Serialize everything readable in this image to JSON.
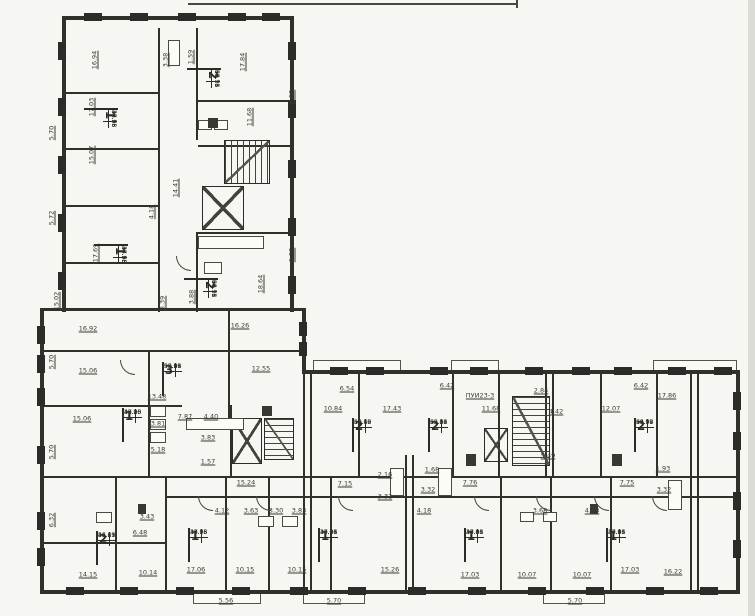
{
  "colors": {
    "paper": "#f6f6f2",
    "ink": "#31302b",
    "label_ink": "#3b3a33"
  },
  "apartment_tables": [
    {
      "rooms": "2",
      "x": 203,
      "y": 52,
      "rot": 1,
      "values": [
        "34.78",
        "59.71",
        "62.96",
        "66.15"
      ]
    },
    {
      "rooms": "1",
      "x": 100,
      "y": 92,
      "rot": 1,
      "values": [
        "17.06",
        "34.98",
        "37.75",
        "40.55"
      ]
    },
    {
      "rooms": "1",
      "x": 110,
      "y": 228,
      "rot": 1,
      "values": [
        "17.06",
        "34.98",
        "37.75",
        "40.55"
      ]
    },
    {
      "rooms": "2",
      "x": 200,
      "y": 262,
      "rot": 1,
      "values": [
        "34.78",
        "59.71",
        "62.96",
        "66.15"
      ]
    },
    {
      "rooms": "3",
      "x": 162,
      "y": 362,
      "rot": 0,
      "values": [
        "50.26",
        "93.98",
        "96.81",
        "99.66"
      ]
    },
    {
      "rooms": "1",
      "x": 122,
      "y": 408,
      "rot": 0,
      "values": [
        "15.06",
        "37.20",
        "40.05",
        "42.90"
      ]
    },
    {
      "rooms": "2",
      "x": 96,
      "y": 531,
      "rot": 0,
      "values": [
        "26.29",
        "45.15",
        "48.41",
        "51.67"
      ]
    },
    {
      "rooms": "1",
      "x": 188,
      "y": 528,
      "rot": 0,
      "values": [
        "17.06",
        "34.98",
        "37.75",
        "40.55"
      ]
    },
    {
      "rooms": "1",
      "x": 318,
      "y": 528,
      "rot": 0,
      "values": [
        "17.06",
        "34.98",
        "37.81",
        "40.66"
      ]
    },
    {
      "rooms": "2",
      "x": 352,
      "y": 418,
      "rot": 0,
      "values": [
        "32.69",
        "58.16",
        "59.43",
        "62.70"
      ]
    },
    {
      "rooms": "2",
      "x": 428,
      "y": 418,
      "rot": 0,
      "values": [
        "35.56",
        "60.00",
        "63.21",
        "66.42"
      ]
    },
    {
      "rooms": "2",
      "x": 634,
      "y": 418,
      "rot": 0,
      "values": [
        "34.08",
        "63.57",
        "66.78",
        "69.99"
      ]
    },
    {
      "rooms": "1",
      "x": 464,
      "y": 528,
      "rot": 0,
      "values": [
        "17.03",
        "34.96",
        "37.81",
        "40.66"
      ]
    },
    {
      "rooms": "1",
      "x": 606,
      "y": 528,
      "rot": 0,
      "values": [
        "17.03",
        "34.96",
        "37.81",
        "40.66"
      ]
    }
  ],
  "dimension_labels": [
    {
      "t": "16.94",
      "x": 95,
      "y": 60,
      "r": 1
    },
    {
      "t": "17.84",
      "x": 243,
      "y": 62,
      "r": 1
    },
    {
      "t": "3.38",
      "x": 166,
      "y": 60,
      "r": 1
    },
    {
      "t": "1.59",
      "x": 191,
      "y": 57,
      "r": 1
    },
    {
      "t": "17.03",
      "x": 92,
      "y": 107,
      "r": 1
    },
    {
      "t": "5.70",
      "x": 52,
      "y": 133,
      "r": 1
    },
    {
      "t": "15.07",
      "x": 92,
      "y": 155,
      "r": 1
    },
    {
      "t": "6.52",
      "x": 292,
      "y": 97,
      "r": 1
    },
    {
      "t": "11.68",
      "x": 250,
      "y": 117,
      "r": 1
    },
    {
      "t": "14.41",
      "x": 176,
      "y": 188,
      "r": 1
    },
    {
      "t": "4.18",
      "x": 152,
      "y": 212,
      "r": 1
    },
    {
      "t": "5.72",
      "x": 52,
      "y": 218,
      "r": 1
    },
    {
      "t": "17.69",
      "x": 96,
      "y": 253,
      "r": 1
    },
    {
      "t": "6.52",
      "x": 292,
      "y": 255,
      "r": 1
    },
    {
      "t": "18.64",
      "x": 261,
      "y": 284,
      "r": 1
    },
    {
      "t": "3.88",
      "x": 192,
      "y": 297,
      "r": 1
    },
    {
      "t": "8.39",
      "x": 163,
      "y": 303,
      "r": 1
    },
    {
      "t": "15.02",
      "x": 57,
      "y": 301,
      "r": 1
    },
    {
      "t": "16.92",
      "x": 88,
      "y": 329,
      "r": 0
    },
    {
      "t": "16.26",
      "x": 240,
      "y": 326,
      "r": 0
    },
    {
      "t": "5.70",
      "x": 52,
      "y": 362,
      "r": 1
    },
    {
      "t": "15.06",
      "x": 88,
      "y": 371,
      "r": 0
    },
    {
      "t": "12.55",
      "x": 261,
      "y": 369,
      "r": 0
    },
    {
      "t": "13.48",
      "x": 157,
      "y": 397,
      "r": 0
    },
    {
      "t": "15.06",
      "x": 82,
      "y": 419,
      "r": 0
    },
    {
      "t": "5.70",
      "x": 52,
      "y": 452,
      "r": 1
    },
    {
      "t": "7.87",
      "x": 185,
      "y": 417,
      "r": 0
    },
    {
      "t": "4.40",
      "x": 211,
      "y": 417,
      "r": 0
    },
    {
      "t": "3.81",
      "x": 158,
      "y": 424,
      "r": 0
    },
    {
      "t": "5.18",
      "x": 158,
      "y": 450,
      "r": 0
    },
    {
      "t": "3.83",
      "x": 208,
      "y": 438,
      "r": 0
    },
    {
      "t": "1.57",
      "x": 208,
      "y": 462,
      "r": 0
    },
    {
      "t": "6.32",
      "x": 52,
      "y": 520,
      "r": 1
    },
    {
      "t": "3.43",
      "x": 147,
      "y": 517,
      "r": 0
    },
    {
      "t": "6.48",
      "x": 140,
      "y": 533,
      "r": 0
    },
    {
      "t": "14.15",
      "x": 88,
      "y": 575,
      "r": 0
    },
    {
      "t": "10.14",
      "x": 148,
      "y": 573,
      "r": 0
    },
    {
      "t": "17.06",
      "x": 196,
      "y": 570,
      "r": 0
    },
    {
      "t": "10.15",
      "x": 245,
      "y": 570,
      "r": 0
    },
    {
      "t": "5.56",
      "x": 226,
      "y": 601,
      "r": 0
    },
    {
      "t": "4.12",
      "x": 222,
      "y": 511,
      "r": 0
    },
    {
      "t": "3.63",
      "x": 251,
      "y": 511,
      "r": 0
    },
    {
      "t": "3.30",
      "x": 276,
      "y": 511,
      "r": 0
    },
    {
      "t": "3.83",
      "x": 299,
      "y": 511,
      "r": 0
    },
    {
      "t": "10.15",
      "x": 297,
      "y": 570,
      "r": 0
    },
    {
      "t": "15.26",
      "x": 390,
      "y": 570,
      "r": 0
    },
    {
      "t": "5.70",
      "x": 334,
      "y": 601,
      "r": 0
    },
    {
      "t": "15.24",
      "x": 246,
      "y": 483,
      "r": 0
    },
    {
      "t": "7.15",
      "x": 345,
      "y": 484,
      "r": 0
    },
    {
      "t": "2.16",
      "x": 385,
      "y": 475,
      "r": 0
    },
    {
      "t": "3.32",
      "x": 385,
      "y": 497,
      "r": 0
    },
    {
      "t": "1.68",
      "x": 432,
      "y": 470,
      "r": 0
    },
    {
      "t": "3.32",
      "x": 428,
      "y": 490,
      "r": 0
    },
    {
      "t": "7.76",
      "x": 470,
      "y": 483,
      "r": 0
    },
    {
      "t": "7.75",
      "x": 627,
      "y": 483,
      "r": 0
    },
    {
      "t": "1.93",
      "x": 663,
      "y": 469,
      "r": 0
    },
    {
      "t": "3.32",
      "x": 664,
      "y": 490,
      "r": 0
    },
    {
      "t": "6.54",
      "x": 347,
      "y": 389,
      "r": 0
    },
    {
      "t": "10.84",
      "x": 333,
      "y": 409,
      "r": 0
    },
    {
      "t": "17.43",
      "x": 392,
      "y": 409,
      "r": 0
    },
    {
      "t": "6.42",
      "x": 447,
      "y": 386,
      "r": 0
    },
    {
      "t": "11.68",
      "x": 491,
      "y": 409,
      "r": 0
    },
    {
      "t": "ПУИ23-3",
      "x": 480,
      "y": 396,
      "r": 0
    },
    {
      "t": "2.84",
      "x": 541,
      "y": 391,
      "r": 0
    },
    {
      "t": "4.42",
      "x": 556,
      "y": 412,
      "r": 0
    },
    {
      "t": "12.07",
      "x": 611,
      "y": 409,
      "r": 0
    },
    {
      "t": "6.42",
      "x": 641,
      "y": 386,
      "r": 0
    },
    {
      "t": "17.86",
      "x": 667,
      "y": 396,
      "r": 0
    },
    {
      "t": "5.49",
      "x": 548,
      "y": 456,
      "r": 0
    },
    {
      "t": "4.18",
      "x": 424,
      "y": 511,
      "r": 0
    },
    {
      "t": "3.68",
      "x": 540,
      "y": 511,
      "r": 0
    },
    {
      "t": "4.18",
      "x": 592,
      "y": 511,
      "r": 0
    },
    {
      "t": "17.03",
      "x": 470,
      "y": 575,
      "r": 0
    },
    {
      "t": "10.07",
      "x": 527,
      "y": 575,
      "r": 0
    },
    {
      "t": "10.07",
      "x": 582,
      "y": 575,
      "r": 0
    },
    {
      "t": "17.03",
      "x": 630,
      "y": 570,
      "r": 0
    },
    {
      "t": "16.22",
      "x": 673,
      "y": 572,
      "r": 0
    },
    {
      "t": "5.70",
      "x": 575,
      "y": 601,
      "r": 0
    }
  ],
  "geometry": {
    "walls": [
      [
        62,
        16,
        232,
        4
      ],
      [
        62,
        16,
        4,
        296
      ],
      [
        290,
        16,
        4,
        296
      ],
      [
        40,
        308,
        266,
        3
      ],
      [
        40,
        308,
        4,
        286
      ],
      [
        302,
        308,
        4,
        66
      ],
      [
        302,
        370,
        438,
        4
      ],
      [
        736,
        370,
        4,
        224
      ],
      [
        40,
        590,
        700,
        4
      ],
      [
        40,
        476,
        700,
        2
      ],
      [
        165,
        496,
        571,
        2
      ],
      [
        40,
        350,
        262,
        2
      ],
      [
        40,
        405,
        142,
        2
      ],
      [
        148,
        350,
        2,
        126
      ],
      [
        228,
        308,
        2,
        112
      ],
      [
        158,
        28,
        2,
        284
      ],
      [
        196,
        28,
        2,
        112
      ],
      [
        196,
        232,
        2,
        80
      ],
      [
        62,
        92,
        96,
        2
      ],
      [
        62,
        148,
        96,
        2
      ],
      [
        62,
        205,
        96,
        2
      ],
      [
        62,
        262,
        96,
        2
      ],
      [
        198,
        100,
        94,
        2
      ],
      [
        198,
        145,
        94,
        2
      ],
      [
        198,
        232,
        94,
        2
      ],
      [
        115,
        478,
        2,
        114
      ],
      [
        165,
        478,
        2,
        114
      ],
      [
        225,
        478,
        2,
        114
      ],
      [
        268,
        478,
        2,
        114
      ],
      [
        330,
        478,
        2,
        114
      ],
      [
        500,
        478,
        2,
        114
      ],
      [
        550,
        478,
        2,
        114
      ],
      [
        610,
        478,
        2,
        114
      ],
      [
        303,
        374,
        2,
        218
      ],
      [
        310,
        374,
        2,
        218
      ],
      [
        405,
        455,
        2,
        137
      ],
      [
        412,
        455,
        2,
        137
      ],
      [
        545,
        372,
        2,
        106
      ],
      [
        552,
        372,
        2,
        106
      ],
      [
        690,
        372,
        2,
        220
      ],
      [
        697,
        372,
        2,
        220
      ],
      [
        358,
        372,
        2,
        106
      ],
      [
        452,
        372,
        2,
        106
      ],
      [
        498,
        372,
        2,
        106
      ],
      [
        600,
        372,
        2,
        106
      ],
      [
        656,
        372,
        2,
        106
      ],
      [
        230,
        405,
        2,
        73
      ],
      [
        40,
        542,
        126,
        2
      ]
    ],
    "piers": [
      [
        58,
        42,
        8,
        18
      ],
      [
        58,
        98,
        8,
        18
      ],
      [
        58,
        156,
        8,
        18
      ],
      [
        58,
        214,
        8,
        18
      ],
      [
        58,
        272,
        8,
        18
      ],
      [
        288,
        42,
        8,
        18
      ],
      [
        288,
        100,
        8,
        18
      ],
      [
        288,
        160,
        8,
        18
      ],
      [
        288,
        218,
        8,
        18
      ],
      [
        288,
        276,
        8,
        18
      ],
      [
        84,
        13,
        18,
        8
      ],
      [
        130,
        13,
        18,
        8
      ],
      [
        178,
        13,
        18,
        8
      ],
      [
        228,
        13,
        18,
        8
      ],
      [
        262,
        13,
        18,
        8
      ],
      [
        37,
        326,
        8,
        18
      ],
      [
        37,
        355,
        8,
        18
      ],
      [
        37,
        388,
        8,
        18
      ],
      [
        37,
        446,
        8,
        18
      ],
      [
        37,
        512,
        8,
        18
      ],
      [
        37,
        548,
        8,
        18
      ],
      [
        330,
        367,
        18,
        8
      ],
      [
        366,
        367,
        18,
        8
      ],
      [
        430,
        367,
        18,
        8
      ],
      [
        470,
        367,
        18,
        8
      ],
      [
        525,
        367,
        18,
        8
      ],
      [
        572,
        367,
        18,
        8
      ],
      [
        614,
        367,
        18,
        8
      ],
      [
        668,
        367,
        18,
        8
      ],
      [
        714,
        367,
        18,
        8
      ],
      [
        66,
        587,
        18,
        8
      ],
      [
        120,
        587,
        18,
        8
      ],
      [
        176,
        587,
        18,
        8
      ],
      [
        232,
        587,
        18,
        8
      ],
      [
        290,
        587,
        18,
        8
      ],
      [
        348,
        587,
        18,
        8
      ],
      [
        408,
        587,
        18,
        8
      ],
      [
        468,
        587,
        18,
        8
      ],
      [
        528,
        587,
        18,
        8
      ],
      [
        586,
        587,
        18,
        8
      ],
      [
        646,
        587,
        18,
        8
      ],
      [
        700,
        587,
        18,
        8
      ],
      [
        733,
        392,
        8,
        18
      ],
      [
        733,
        432,
        8,
        18
      ],
      [
        733,
        492,
        8,
        18
      ],
      [
        733,
        540,
        8,
        18
      ],
      [
        299,
        322,
        8,
        14
      ],
      [
        299,
        342,
        8,
        14
      ]
    ],
    "cores": [
      {
        "x": 224,
        "y": 140,
        "w": 46,
        "h": 44,
        "kind": "stairs-v"
      },
      {
        "x": 202,
        "y": 186,
        "w": 42,
        "h": 44,
        "kind": "x"
      },
      {
        "x": 232,
        "y": 418,
        "w": 30,
        "h": 46,
        "kind": "x"
      },
      {
        "x": 264,
        "y": 418,
        "w": 30,
        "h": 42,
        "kind": "stairs-h"
      },
      {
        "x": 512,
        "y": 396,
        "w": 38,
        "h": 70,
        "kind": "stairs-h"
      },
      {
        "x": 484,
        "y": 428,
        "w": 24,
        "h": 34,
        "kind": "x"
      }
    ],
    "balconies": [
      [
        193,
        592,
        68,
        12
      ],
      [
        303,
        592,
        62,
        12
      ],
      [
        543,
        592,
        62,
        12
      ],
      [
        313,
        360,
        88,
        11
      ],
      [
        451,
        360,
        48,
        11
      ],
      [
        653,
        360,
        84,
        11
      ]
    ],
    "fixtures": [
      [
        150,
        406,
        16,
        11
      ],
      [
        150,
        419,
        16,
        11
      ],
      [
        150,
        432,
        16,
        11
      ],
      [
        186,
        418,
        58,
        12
      ],
      [
        198,
        236,
        66,
        13
      ],
      [
        204,
        262,
        18,
        12
      ],
      [
        96,
        512,
        16,
        11
      ],
      [
        258,
        516,
        16,
        11
      ],
      [
        282,
        516,
        16,
        11
      ],
      [
        520,
        512,
        14,
        10
      ],
      [
        543,
        512,
        14,
        10
      ],
      [
        390,
        468,
        14,
        28
      ],
      [
        438,
        468,
        14,
        28
      ],
      [
        668,
        480,
        14,
        30
      ],
      [
        168,
        40,
        12,
        26
      ],
      [
        198,
        120,
        14,
        10
      ],
      [
        214,
        120,
        14,
        10
      ]
    ],
    "solids": [
      [
        466,
        454,
        10,
        12
      ],
      [
        612,
        454,
        10,
        12
      ],
      [
        262,
        406,
        10,
        10
      ],
      [
        208,
        118,
        10,
        10
      ],
      [
        138,
        504,
        8,
        10
      ],
      [
        590,
        504,
        8,
        10
      ]
    ],
    "arcs": [
      [
        198,
        496
      ],
      [
        256,
        496
      ],
      [
        338,
        496
      ],
      [
        474,
        496
      ],
      [
        536,
        496
      ],
      [
        594,
        496
      ],
      [
        652,
        496
      ],
      [
        120,
        360
      ],
      [
        176,
        256
      ]
    ],
    "artifacts": [
      {
        "x": 188,
        "y": 3,
        "w": 330,
        "h": 2,
        "kind": "line"
      },
      {
        "x": 516,
        "y": 0,
        "w": 2,
        "h": 8,
        "kind": "line"
      },
      {
        "x": 748,
        "y": 0,
        "w": 7,
        "h": 616,
        "kind": "strip"
      }
    ]
  }
}
